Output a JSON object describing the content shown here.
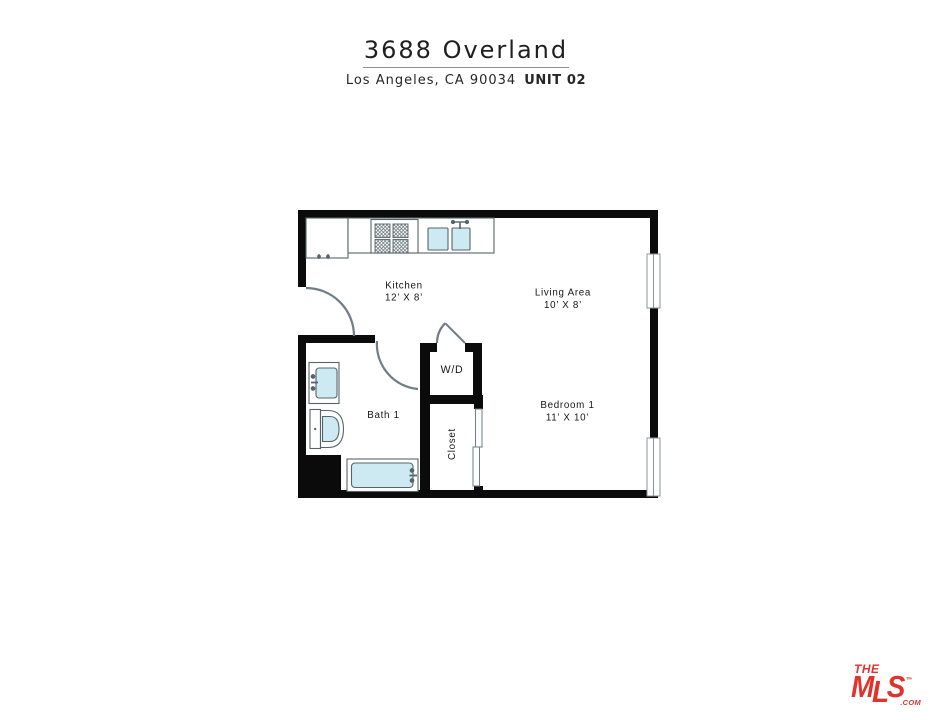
{
  "header": {
    "title": "3688 Overland",
    "address": "Los Angeles, CA 90034",
    "unit": "UNIT 02"
  },
  "floorplan": {
    "labels": {
      "kitchen": {
        "name": "Kitchen",
        "dims": "12’ X 8’"
      },
      "living": {
        "name": "Living Area",
        "dims": "10’ X 8’"
      },
      "bedroom": {
        "name": "Bedroom 1",
        "dims": "11’ X 10’"
      },
      "bath": {
        "name": "Bath 1"
      },
      "wd": {
        "name": "W/D"
      },
      "closet": {
        "name": "Closet"
      }
    }
  },
  "logo": {
    "the": "THE",
    "m": "M",
    "l": "L",
    "s": "S",
    "tm": "™",
    "com": ".COM",
    "color": "#e23229"
  },
  "colors": {
    "wall": "#0b0b0b",
    "fixture_line": "#566468",
    "door_line": "#6d7e84",
    "water_fill": "#cdeaf3"
  }
}
